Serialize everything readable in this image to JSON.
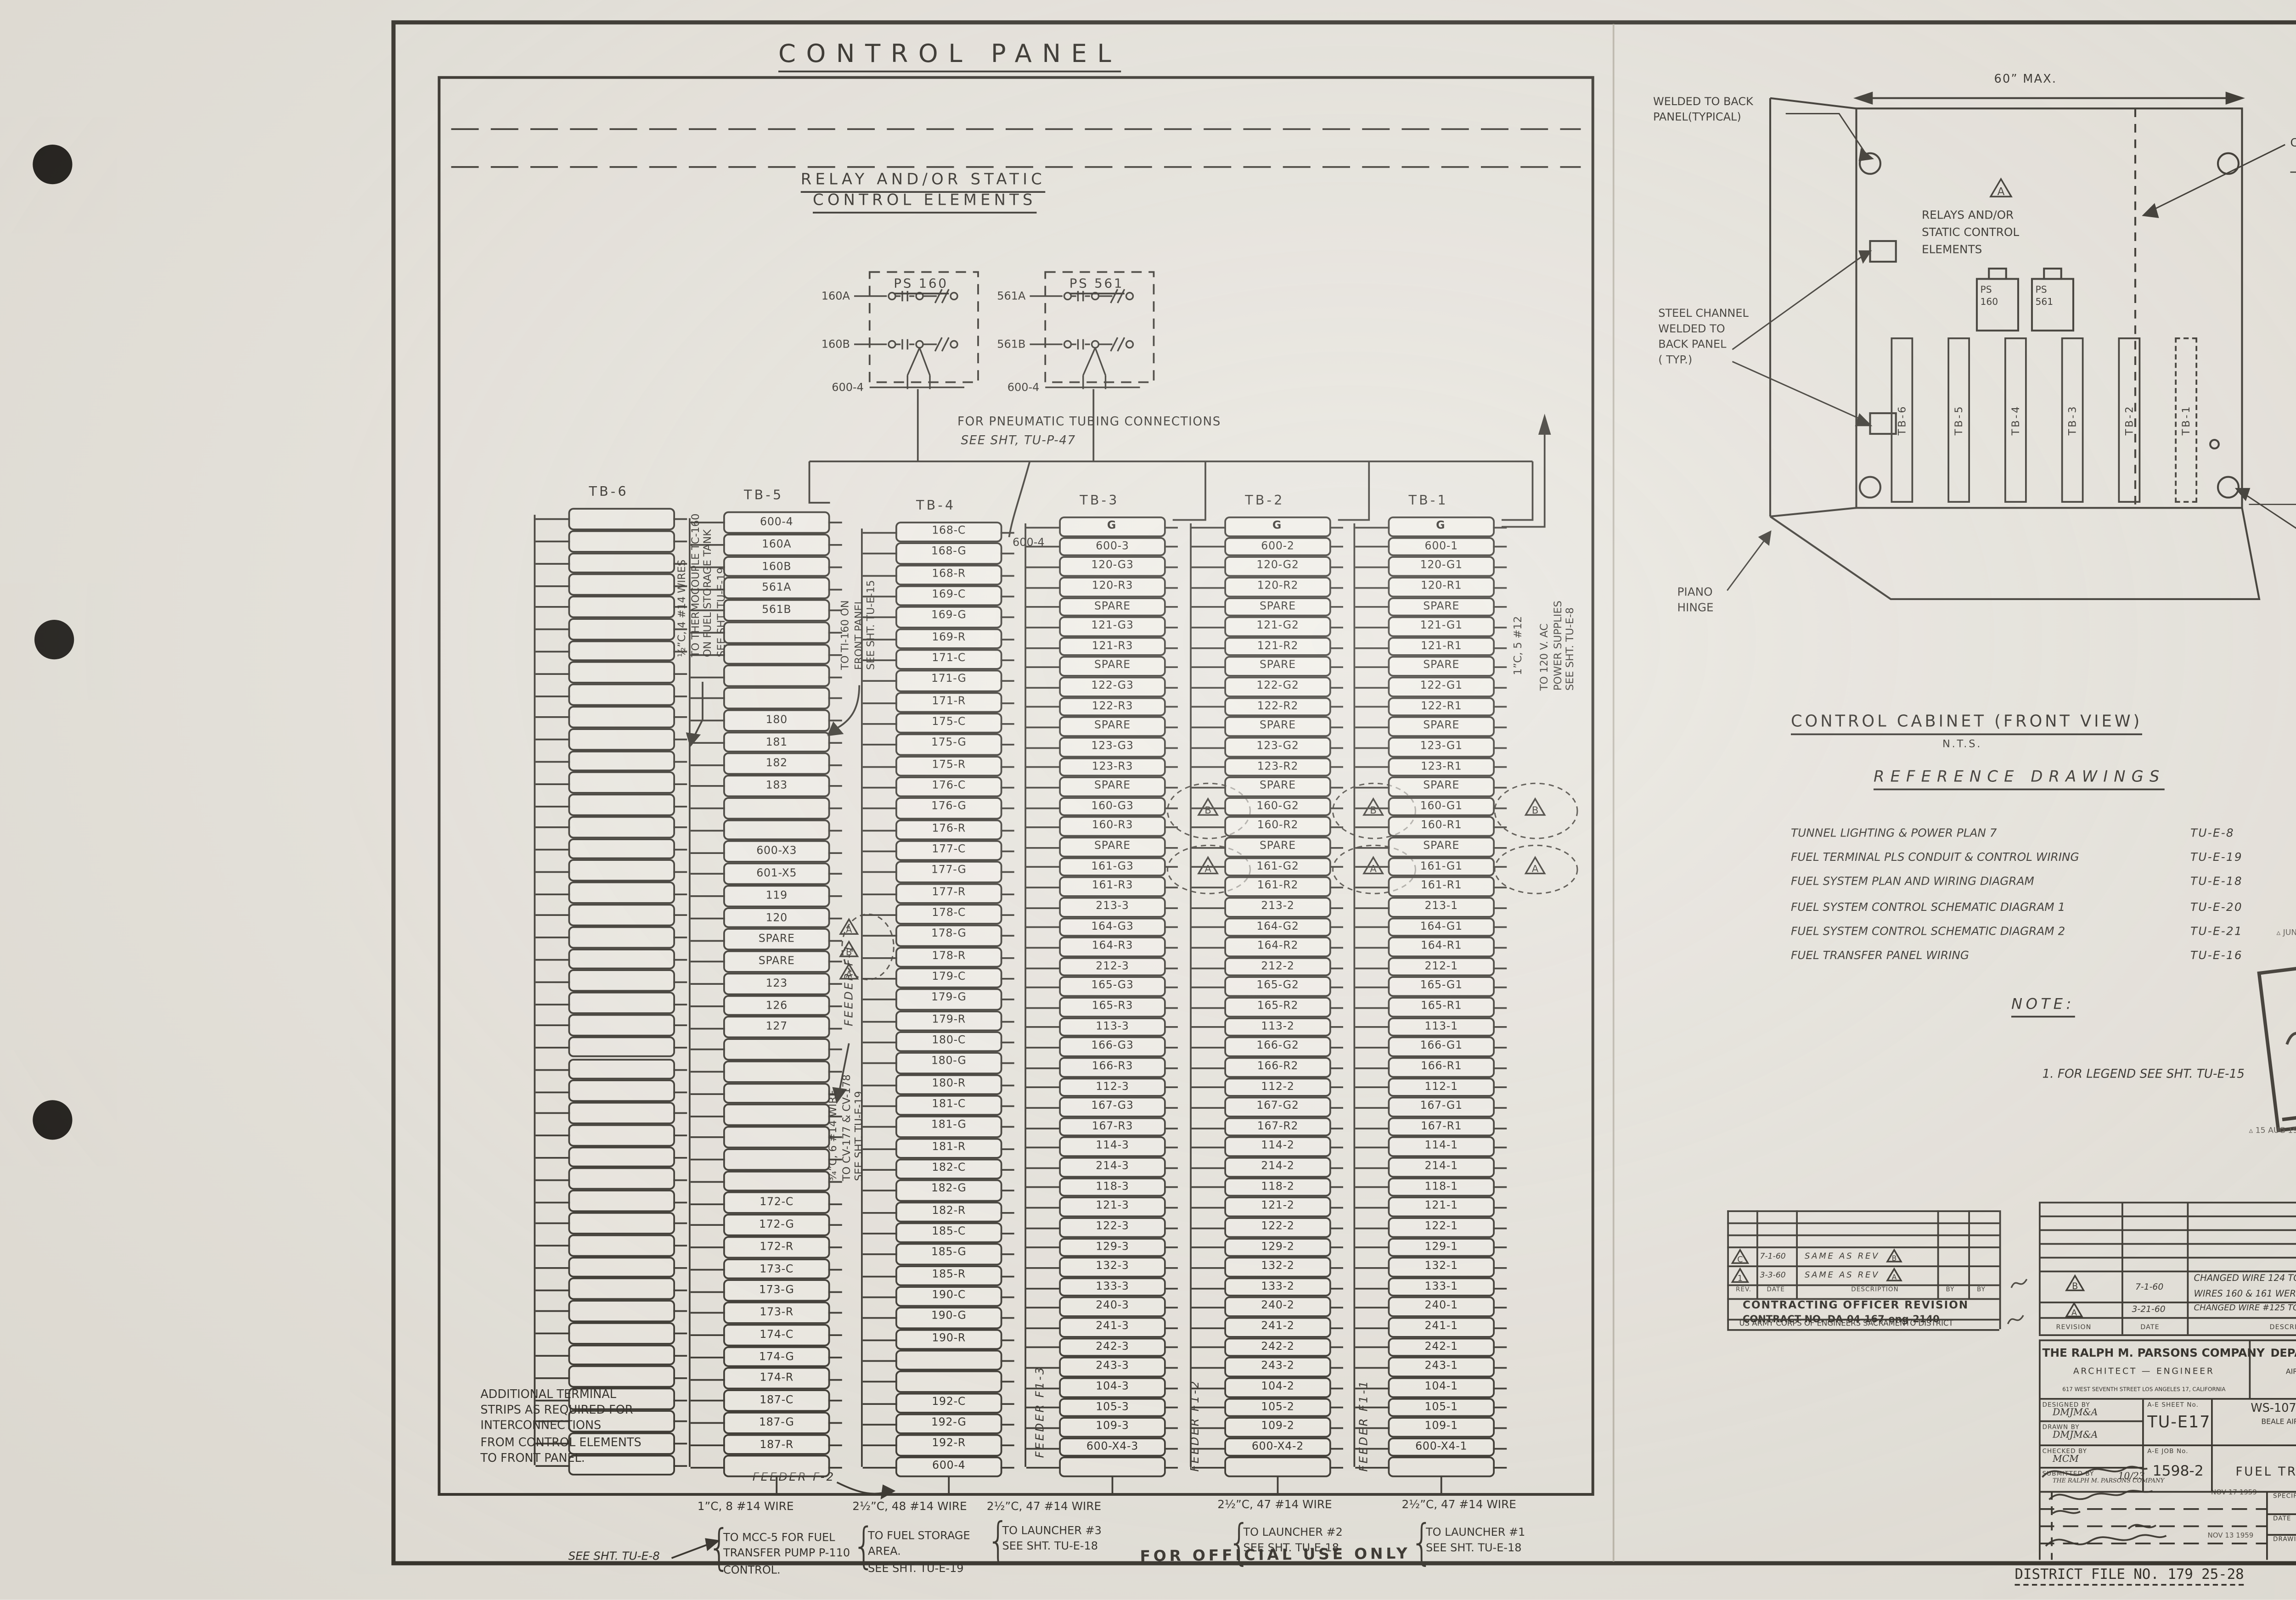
{
  "sheet": {
    "header": {
      "title": "CONTROL PANEL",
      "subtitle": [
        "RELAY AND/OR STATIC",
        "CONTROL ELEMENTS"
      ]
    },
    "relay_schematic": {
      "ps160": "PS 160",
      "ps561": "PS 561",
      "wires_left": [
        "160A",
        "160B"
      ],
      "wires_right": [
        "561A",
        "561B"
      ],
      "common_left": "600-4",
      "common_right": "600-4",
      "tb4_tap": "600-4",
      "note": [
        "FOR PNEUMATIC TUBING CONNECTIONS",
        "SEE SHT, TU-P-47"
      ]
    },
    "terminal_blocks": [
      {
        "label": "TB-6",
        "blank_count": 44,
        "rows": []
      },
      {
        "label": "TB-5",
        "rows": [
          "600-4",
          "160A",
          "160B",
          "561A",
          "561B",
          "",
          "",
          "",
          "",
          "180",
          "181",
          "182",
          "183",
          "",
          "",
          "600-X3",
          "601-X5",
          "119",
          "120",
          "SPARE",
          "SPARE",
          "123",
          "126",
          "127",
          "",
          "",
          "",
          "",
          "",
          "",
          "",
          "172-C",
          "172-G",
          "172-R",
          "173-C",
          "173-G",
          "173-R",
          "174-C",
          "174-G",
          "174-R",
          "187-C",
          "187-G",
          "187-R",
          ""
        ]
      },
      {
        "label": "TB-4",
        "rows": [
          "168-C",
          "168-G",
          "168-R",
          "169-C",
          "169-G",
          "169-R",
          "171-C",
          "171-G",
          "171-R",
          "175-C",
          "175-G",
          "175-R",
          "176-C",
          "176-G",
          "176-R",
          "177-C",
          "177-G",
          "177-R",
          "178-C",
          "178-G",
          "178-R",
          "179-C",
          "179-G",
          "179-R",
          "180-C",
          "180-G",
          "180-R",
          "181-C",
          "181-G",
          "181-R",
          "182-C",
          "182-G",
          "182-R",
          "185-C",
          "185-G",
          "185-R",
          "190-C",
          "190-G",
          "190-R",
          "",
          "",
          "192-C",
          "192-G",
          "192-R",
          "600-4"
        ]
      },
      {
        "label": "TB-3",
        "rows": [
          "G",
          "600-3",
          "120-G3",
          "120-R3",
          "SPARE",
          "121-G3",
          "121-R3",
          "SPARE",
          "122-G3",
          "122-R3",
          "SPARE",
          "123-G3",
          "123-R3",
          "SPARE",
          "160-G3",
          "160-R3",
          "SPARE",
          "161-G3",
          "161-R3",
          "213-3",
          "164-G3",
          "164-R3",
          "212-3",
          "165-G3",
          "165-R3",
          "113-3",
          "166-G3",
          "166-R3",
          "112-3",
          "167-G3",
          "167-R3",
          "114-3",
          "214-3",
          "118-3",
          "121-3",
          "122-3",
          "129-3",
          "132-3",
          "133-3",
          "240-3",
          "241-3",
          "242-3",
          "243-3",
          "104-3",
          "105-3",
          "109-3",
          "600-X4-3",
          ""
        ]
      },
      {
        "label": "TB-2",
        "rows": [
          "G",
          "600-2",
          "120-G2",
          "120-R2",
          "SPARE",
          "121-G2",
          "121-R2",
          "SPARE",
          "122-G2",
          "122-R2",
          "SPARE",
          "123-G2",
          "123-R2",
          "SPARE",
          "160-G2",
          "160-R2",
          "SPARE",
          "161-G2",
          "161-R2",
          "213-2",
          "164-G2",
          "164-R2",
          "212-2",
          "165-G2",
          "165-R2",
          "113-2",
          "166-G2",
          "166-R2",
          "112-2",
          "167-G2",
          "167-R2",
          "114-2",
          "214-2",
          "118-2",
          "121-2",
          "122-2",
          "129-2",
          "132-2",
          "133-2",
          "240-2",
          "241-2",
          "242-2",
          "243-2",
          "104-2",
          "105-2",
          "109-2",
          "600-X4-2",
          ""
        ]
      },
      {
        "label": "TB-1",
        "rows": [
          "G",
          "600-1",
          "120-G1",
          "120-R1",
          "SPARE",
          "121-G1",
          "121-R1",
          "SPARE",
          "122-G1",
          "122-R1",
          "SPARE",
          "123-G1",
          "123-R1",
          "SPARE",
          "160-G1",
          "160-R1",
          "SPARE",
          "161-G1",
          "161-R1",
          "213-1",
          "164-G1",
          "164-R1",
          "212-1",
          "165-G1",
          "165-R1",
          "113-1",
          "166-G1",
          "166-R1",
          "112-1",
          "167-G1",
          "167-R1",
          "114-1",
          "214-1",
          "118-1",
          "121-1",
          "122-1",
          "129-1",
          "132-1",
          "133-1",
          "240-1",
          "241-1",
          "242-1",
          "243-1",
          "104-1",
          "105-1",
          "109-1",
          "600-X4-1",
          ""
        ]
      }
    ],
    "side_notes": {
      "thermocouple": [
        "½”C, 4 #14 WIRES",
        "TO THERMOCOUPLE TC-160",
        "ON FUEL STORAGE TANK",
        "SEE SHT. TU-E-19"
      ],
      "ti160": [
        "TO TI-160 ON",
        "FRONT PANEL",
        "SEE SHT. TU-E-15"
      ],
      "cv": [
        "¾”C, 6 #14 WIRE",
        "TO CV-177 & CV-178",
        "SEE SHT. TU-E-19"
      ],
      "power_conduit": "1”C, 5 #12",
      "power": [
        "TO 120 V. AC",
        "POWER SUPPLIES",
        "SEE SHT. TU-E-8"
      ]
    },
    "feeders": {
      "f1": "FEEDER F-1",
      "f2": "FEEDER F-2",
      "f13": "FEEDER F1-3",
      "f12": "FEEDER F1-2",
      "f11": "FEEDER F1-1"
    },
    "additional_note": [
      "ADDITIONAL TERMINAL",
      "STRIPS AS REQUIRED FOR",
      "INTERCONNECTIONS",
      "FROM CONTROL ELEMENTS",
      "TO FRONT PANEL."
    ],
    "see_sht_tu_e8": "SEE SHT. TU-E-8",
    "conduit_notes": [
      {
        "wire": "1”C, 8 #14 WIRE",
        "dest": [
          "TO MCC-5 FOR FUEL",
          "TRANSFER PUMP P-110",
          "CONTROL."
        ]
      },
      {
        "wire": "2½”C, 48 #14 WIRE",
        "dest": [
          "TO FUEL STORAGE",
          "AREA.",
          "SEE SHT. TU-E-19"
        ]
      },
      {
        "wire": "2½”C, 47 #14 WIRE",
        "dest": [
          "TO LAUNCHER #3",
          "SEE SHT. TU-E-18"
        ]
      },
      {
        "wire": "2½”C, 47 #14 WIRE",
        "dest": [
          "TO LAUNCHER #2",
          "SEE SHT. TU-E-18"
        ]
      },
      {
        "wire": "2½”C, 47 #14 WIRE",
        "dest": [
          "TO LAUNCHER #1",
          "SEE SHT. TU-E-18"
        ]
      }
    ],
    "cabinet": {
      "welded": [
        "WELDED TO BACK",
        "PANEL(TYPICAL)"
      ],
      "dim_w": "60” MAX.",
      "dim_h": "90” MAX.",
      "control_panel": "CONTROL PANEL",
      "steel": [
        "STEEL CHANNEL",
        "WELDED TO",
        "BACK PANEL",
        "( TYP.)"
      ],
      "hinge_left": [
        "PIANO",
        "HINGE"
      ],
      "hinge_right": [
        "PIANO",
        "HINGE"
      ],
      "relays": [
        "RELAYS AND/OR",
        "STATIC CONTROL",
        "ELEMENTS"
      ],
      "ps160": [
        "PS",
        "160"
      ],
      "ps561": [
        "PS",
        "561"
      ],
      "strips": [
        "TB-6",
        "TB-5",
        "TB-4",
        "TB-3",
        "TB-2",
        "TB-1"
      ]
    },
    "caption": {
      "title": "CONTROL CABINET (FRONT VIEW)",
      "scale": "N.T.S."
    },
    "reference": {
      "title": "REFERENCE DRAWINGS",
      "items": [
        {
          "name": "TUNNEL LIGHTING & POWER PLAN 7",
          "num": "TU-E-8"
        },
        {
          "name": "FUEL TERMINAL PLS CONDUIT & CONTROL WIRING",
          "num": "TU-E-19"
        },
        {
          "name": "FUEL SYSTEM PLAN AND WIRING DIAGRAM",
          "num": "TU-E-18"
        },
        {
          "name": "FUEL SYSTEM CONTROL SCHEMATIC DIAGRAM 1",
          "num": "TU-E-20"
        },
        {
          "name": "FUEL SYSTEM CONTROL SCHEMATIC DIAGRAM 2",
          "num": "TU-E-21"
        },
        {
          "name": "FUEL TRANSFER PANEL WIRING",
          "num": "TU-E-16"
        }
      ]
    },
    "note": {
      "title": "NOTE:",
      "item": "1. FOR LEGEND SEE SHT. TU-E-15"
    },
    "stamp": {
      "top_date": "JUN 1960",
      "top_script": "CNC",
      "line1": "REVIEWED FOR CONSTRUCTION FEASIBILITY",
      "line2": "FOR THE CORPS OF ENGINEERS",
      "name": "CLIFTON M. CHAMBERLAIN, JR.",
      "name2": "Lt Col, Corps of Engineers",
      "bottom_date": "15 AUG 1960"
    },
    "left_revision": {
      "rows": [
        {
          "rev": "C",
          "date": "7-1-60",
          "desc": "SAME AS REV",
          "ref": "B"
        },
        {
          "rev": "1",
          "date": "3-3-60",
          "desc": "SAME AS REV",
          "ref": "A"
        }
      ],
      "headers": [
        "REV.",
        "DATE",
        "DESCRIPTION",
        "BY",
        "BY"
      ],
      "title1": "CONTRACTING OFFICER REVISION",
      "title2": "CONTRACT NO. DA-04-167-eng-2140",
      "title3": "US ARMY CORPS OF ENGINEERS      SACRAMENTO DISTRICT"
    },
    "right_revision": {
      "rows": [
        {
          "rev": "B",
          "date": "7-1-60",
          "lines": [
            "CHANGED WIRE 124 TO SPARE",
            "WIRES 160 & 161 WERE SPARE (6 PLACES)"
          ],
          "agency": "DMJM(A)"
        },
        {
          "rev": "A",
          "date": "3-21-60",
          "lines": [
            "CHANGED WIRE #125 TO #123, WIRE #123 TO SPARE"
          ],
          "agency": "DMJM(A)"
        }
      ],
      "headers": [
        "REVISION",
        "DATE",
        "DESCRIPTION",
        "AGENCY",
        "INIT."
      ]
    },
    "title_block": {
      "firm": {
        "name": "THE RALPH M. PARSONS COMPANY",
        "role": "ARCHITECT  —  ENGINEER",
        "addr": "617 WEST SEVENTH STREET  LOS ANGELES 17, CALIFORNIA"
      },
      "agency": {
        "name": "DEPARTMENT OF THE AIR FORCE",
        "div": "AIR FORCE BALLISTIC MISSILE DIVISION (ARDC)",
        "addr": "LOS ANGELES 45, CALIFORNIA"
      },
      "credits": [
        {
          "label": "DESIGNED BY",
          "value": "DMJM&A"
        },
        {
          "label": "DRAWN BY",
          "value": "DMJM&A"
        },
        {
          "label": "CHECKED BY",
          "value": "MCM"
        },
        {
          "label": "SUBMITTED BY",
          "value": "THE RALPH M. PARSONS COMPANY"
        }
      ],
      "submit_date": "10/23",
      "ae_sheet_label": "A-E SHEET No.",
      "ae_sheet": "TU-E17",
      "ae_job_label": "A-E JOB No.",
      "ae_job": "1598-2",
      "project": [
        "WS-107 A-2  TECHNICAL  FACILITIES",
        "BEALE AIR FORCE BASE, MARYSVILLE, CALIFORNIA",
        "COMPLEX 1A, 1B & 1C"
      ],
      "title": [
        "TUNNEL",
        "FUEL TRANSFER PANEL WIRING",
        "AND CABINET"
      ],
      "approved_dates": [
        "NOV 17 1959",
        "NOV 13 1959"
      ],
      "spec_label": "SPECIFICATION NO.",
      "spec": "2639",
      "date_label": "DATE",
      "scale_label": "SCALE",
      "scale": "NONE",
      "number_label": "DRAWING NUMBER",
      "number": "AW 60-01 17",
      "sheet_label": "SHEET",
      "sheet": "482"
    },
    "revision_markers": {
      "tb5": [
        "A",
        "B",
        "A"
      ],
      "tb3": [
        "B",
        "A"
      ],
      "tb2": [
        "B",
        "A"
      ],
      "tb1": [
        "B",
        "A"
      ],
      "cabinet": "A"
    },
    "footer": {
      "official": "FOR OFFICIAL USE ONLY",
      "district": "DISTRICT FILE NO. 179 25-28"
    }
  }
}
